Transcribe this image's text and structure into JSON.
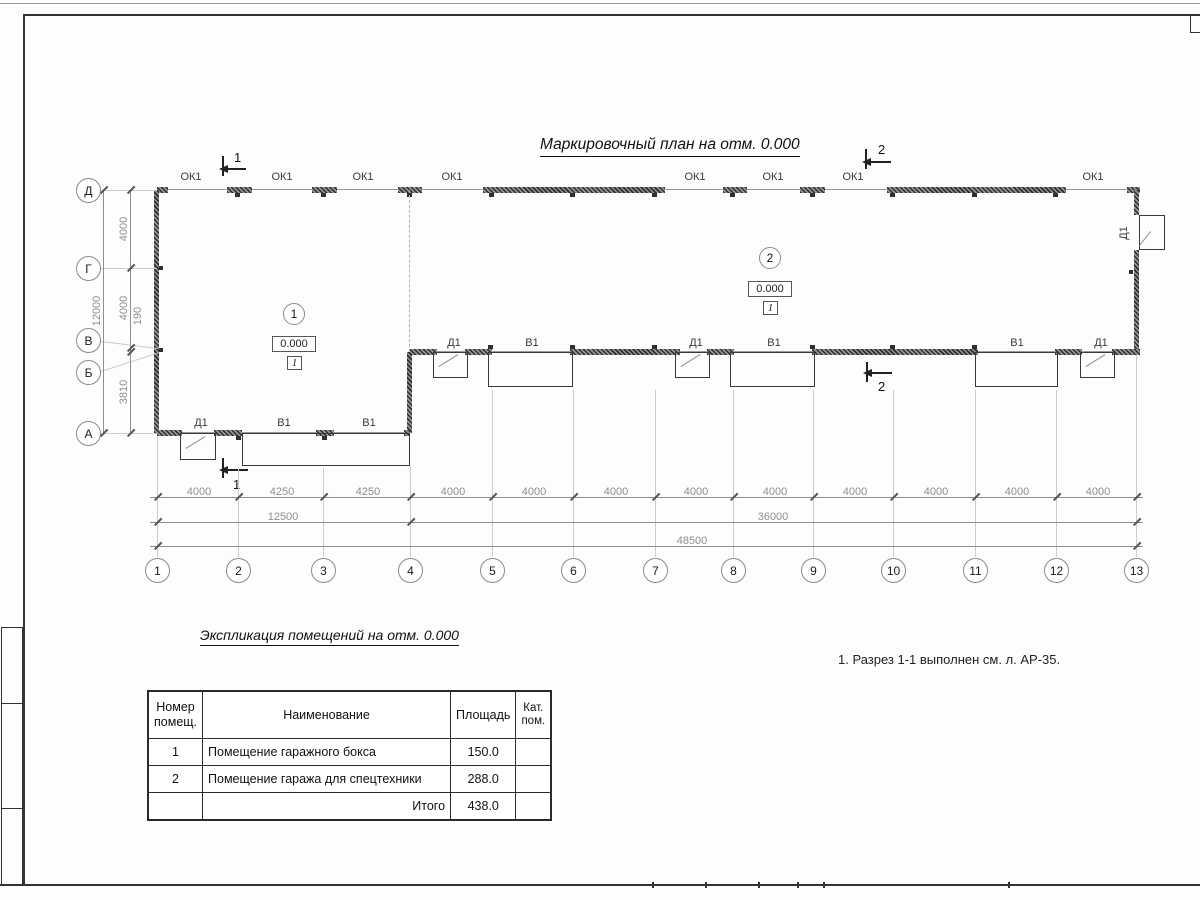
{
  "title": "Маркировочный план на отм. 0.000",
  "labels": {
    "window": "ОК1",
    "gate": "В1",
    "door": "Д1"
  },
  "sections": {
    "s1": "1",
    "s2": "2"
  },
  "rooms": {
    "r1": {
      "num": "1",
      "elev": "0.000",
      "floor": "1"
    },
    "r2": {
      "num": "2",
      "elev": "0.000",
      "floor": "1"
    }
  },
  "axes": {
    "rows": [
      "Д",
      "Г",
      "В",
      "Б",
      "А"
    ],
    "cols": [
      "1",
      "2",
      "3",
      "4",
      "5",
      "6",
      "7",
      "8",
      "9",
      "10",
      "11",
      "12",
      "13"
    ]
  },
  "dims": {
    "left": {
      "d_g": "4000",
      "g_v": "4000",
      "v_b": "190",
      "b_a": "3810",
      "total": "12000"
    },
    "bottom_row1": [
      "4000",
      "4250",
      "4250",
      "4000",
      "4000",
      "4000",
      "4000",
      "4000",
      "4000",
      "4000",
      "4000",
      "4000"
    ],
    "bottom_row2": {
      "left": "12500",
      "right": "36000"
    },
    "bottom_total": "48500"
  },
  "note": "1. Разрез 1-1 выполнен см. л. АР-35.",
  "table": {
    "title": "Экспликация помещений на отм. 0.000",
    "headers": {
      "num": "Номер помещ.",
      "name": "Наименование",
      "area": "Площадь",
      "cat": "Кат. пом."
    },
    "rows": [
      {
        "num": "1",
        "name": "Помещение гаражного бокса",
        "area": "150.0",
        "cat": ""
      },
      {
        "num": "2",
        "name": "Помещение гаража для спецтехники",
        "area": "288.0",
        "cat": ""
      }
    ],
    "total_label": "Итого",
    "total_value": "438.0"
  }
}
